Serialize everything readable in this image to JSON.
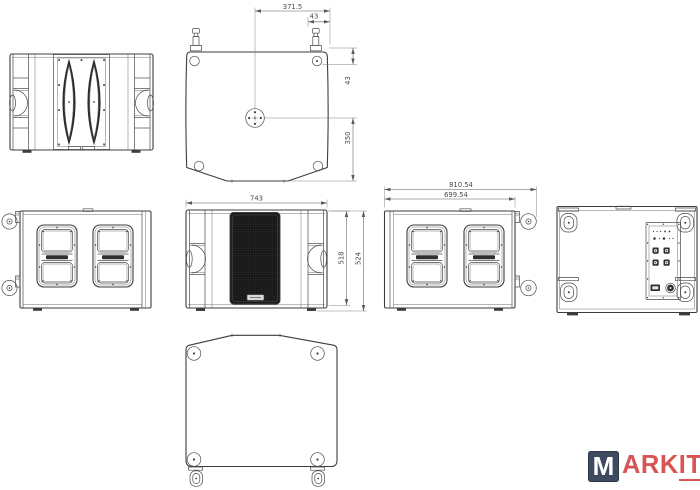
{
  "drawing": {
    "background": "#ffffff",
    "line_color": "#3d3d3d",
    "grille_color": "#181818",
    "dimensions": {
      "top_view": {
        "half_width": "371.5",
        "track_offset": "43",
        "corner_inset": "43",
        "center_to_rear": "350"
      },
      "front_view": {
        "width": "743",
        "cabinet_height": "518",
        "overall_height": "524"
      },
      "side_view": {
        "overall_depth": "810.54",
        "cabinet_depth": "699.54"
      }
    }
  },
  "logo": {
    "m": "M",
    "ark": "ARK",
    "it": "IT",
    "mark_bg": "#3e4b5e",
    "text_color": "#d95454"
  }
}
